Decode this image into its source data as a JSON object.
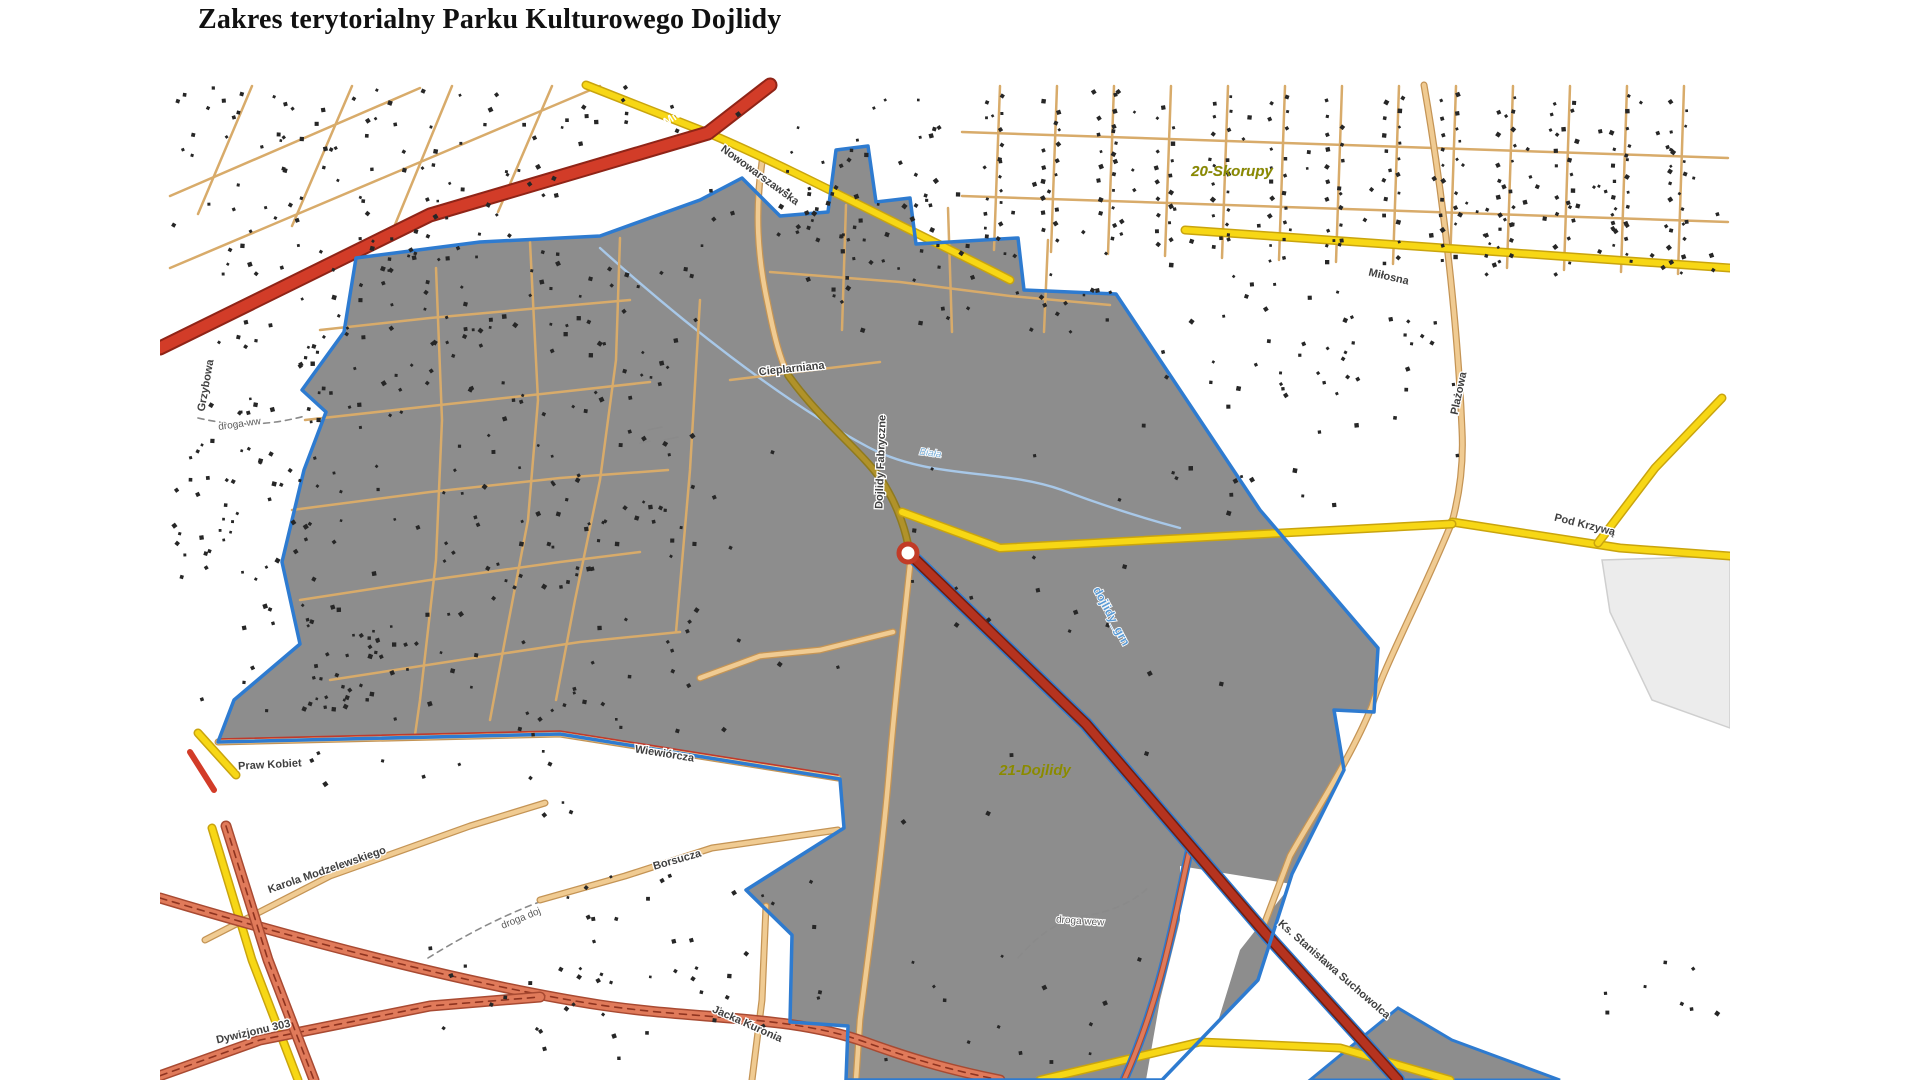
{
  "page": {
    "title": "Zakres terytorialny Parku Kulturowego Dojlidy"
  },
  "map": {
    "district_labels": [
      {
        "text": "20-Skorupy",
        "x": 1232,
        "y": 176,
        "rot": 0,
        "cls": "lbl-district"
      },
      {
        "text": "21-Dojlidy",
        "x": 1035,
        "y": 775,
        "rot": 0,
        "cls": "lbl-district"
      }
    ],
    "street_labels": [
      {
        "text": "A. Mickiewicza",
        "x": 688,
        "y": 112,
        "rot": -33,
        "cls": "lbl-onroad"
      },
      {
        "text": "Nowowarszawska",
        "x": 758,
        "y": 178,
        "rot": 36,
        "cls": "lbl-street"
      },
      {
        "text": "Miłosna",
        "x": 1388,
        "y": 280,
        "rot": 13,
        "cls": "lbl-street"
      },
      {
        "text": "Plażowa",
        "x": 1462,
        "y": 394,
        "rot": -78,
        "cls": "lbl-street"
      },
      {
        "text": "Pod Krzywą",
        "x": 1584,
        "y": 528,
        "rot": 14,
        "cls": "lbl-street"
      },
      {
        "text": "Grzybowa",
        "x": 209,
        "y": 386,
        "rot": -80,
        "cls": "lbl-street"
      },
      {
        "text": "Cieplarniana",
        "x": 792,
        "y": 372,
        "rot": -6,
        "cls": "lbl-street"
      },
      {
        "text": "Dojlidy Fabryczne",
        "x": 884,
        "y": 462,
        "rot": -88,
        "cls": "lbl-street"
      },
      {
        "text": "Praw Kobiet",
        "x": 270,
        "y": 768,
        "rot": -3,
        "cls": "lbl-street"
      },
      {
        "text": "Wiewiórcza",
        "x": 664,
        "y": 757,
        "rot": 9,
        "cls": "lbl-street"
      },
      {
        "text": "Borsucza",
        "x": 678,
        "y": 863,
        "rot": -16,
        "cls": "lbl-street"
      },
      {
        "text": "Karola Modzelewskiego",
        "x": 328,
        "y": 873,
        "rot": -19,
        "cls": "lbl-street"
      },
      {
        "text": "Dywizjonu 303",
        "x": 254,
        "y": 1035,
        "rot": -13,
        "cls": "lbl-street"
      },
      {
        "text": "Jacka Kuronia",
        "x": 746,
        "y": 1027,
        "rot": 24,
        "cls": "lbl-street"
      },
      {
        "text": "Ks. Stanisława Suchowolca",
        "x": 1332,
        "y": 972,
        "rot": 41,
        "cls": "lbl-street"
      }
    ],
    "path_labels": [
      {
        "text": "droga ww",
        "x": 240,
        "y": 427,
        "rot": -8,
        "cls": "lbl-path"
      },
      {
        "text": "droga doj",
        "x": 522,
        "y": 921,
        "rot": -22,
        "cls": "lbl-path"
      },
      {
        "text": "droga wew",
        "x": 1080,
        "y": 924,
        "rot": 4,
        "cls": "lbl-path"
      }
    ],
    "water_labels": [
      {
        "text": "Biała",
        "x": 930,
        "y": 456,
        "rot": 8,
        "cls": "lbl-water"
      },
      {
        "text": "dojlidy_grn",
        "x": 1108,
        "y": 618,
        "rot": 62,
        "cls": "lbl-layer"
      }
    ],
    "palette": {
      "park_fill": "#8d8d8d",
      "park_border": "#2e7bd0",
      "road_red": "#d23c28",
      "road_red_casing": "#8f2417",
      "road_darkred": "#b5331f",
      "road_darkred_casing": "#701d10",
      "road_salmon": "#e07a5a",
      "road_salmon_casing": "#a84a32",
      "road_salmon_dash": "#8f3420",
      "road_yellow": "#f7d715",
      "road_yellow_casing": "#c9a40e",
      "road_tan": "#f0cb92",
      "road_tan_casing": "#c49455",
      "road_olive": "#b0922a",
      "road_olive_casing": "#8f7a1e",
      "minor_street": "#d8ab6a",
      "stream": "#a8c8e8",
      "building": "#262626",
      "light_area": "#ececec",
      "path_dash": "#8a8a8a",
      "boundary_red_line": "#c0392b"
    }
  }
}
